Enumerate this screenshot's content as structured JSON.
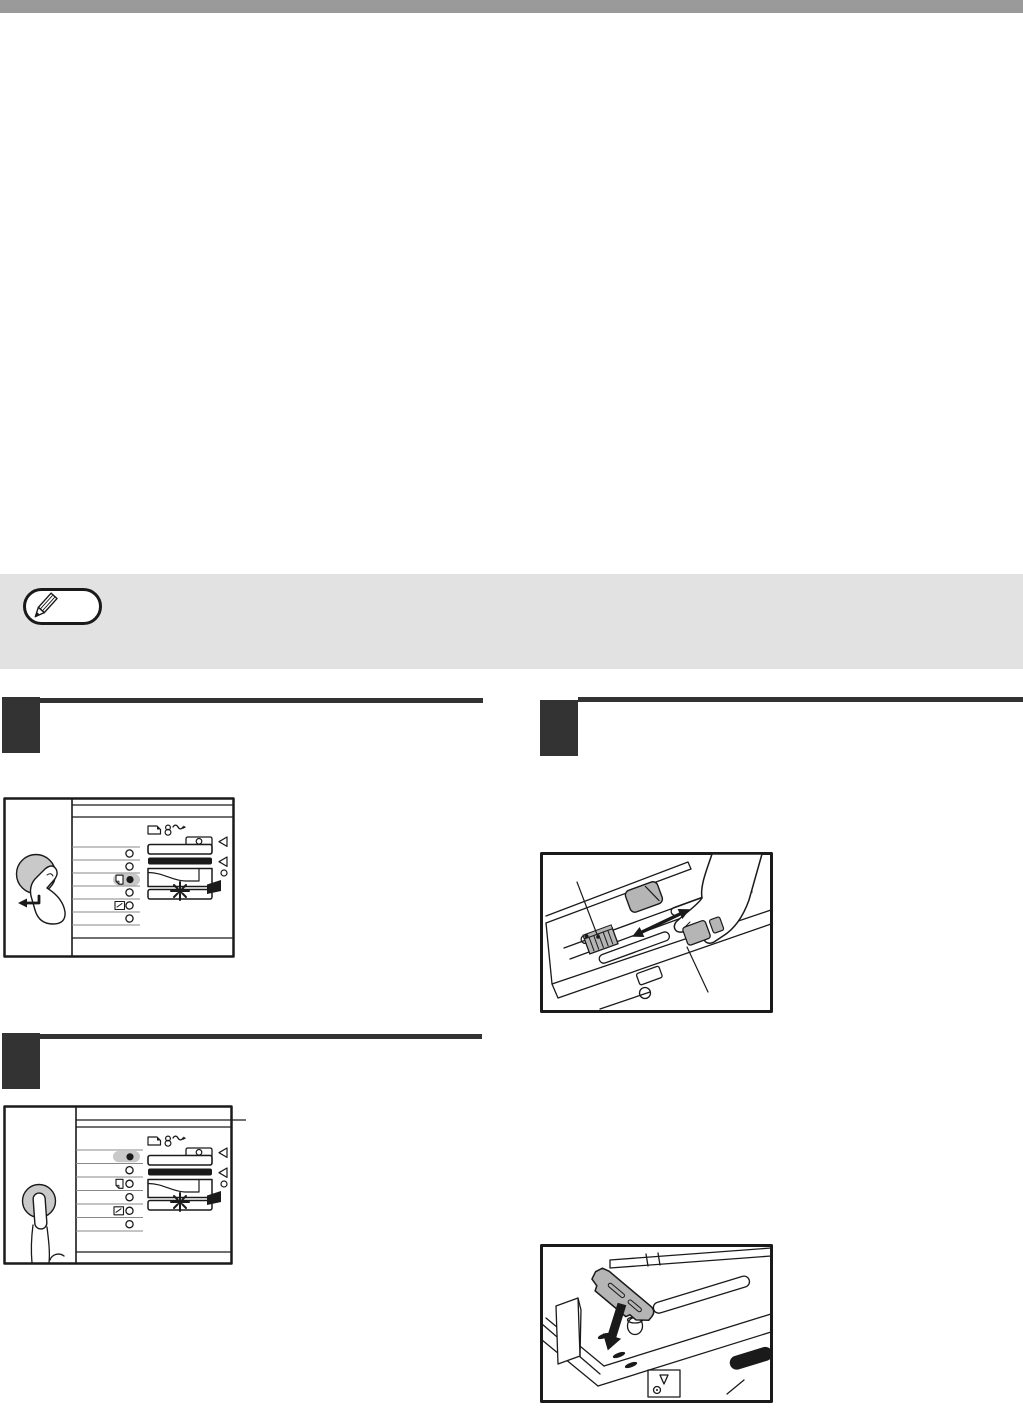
{
  "page": {
    "width": 1023,
    "height": 1412,
    "background": "#ffffff"
  },
  "top_bar": {
    "color": "#9a9a9a",
    "height_px": 13
  },
  "note_box": {
    "background": "#e2e2e2",
    "badge_background": "#ffffff",
    "badge_border": "#1a1a1a",
    "icon": "pencil-icon"
  },
  "colors": {
    "ink": "#1a1a1a",
    "marker": "#333333",
    "row-line": "#8a8a8a",
    "button-gray": "#c9c9c9",
    "guide-gray": "#b5b5b5",
    "note-bg": "#e2e2e2",
    "bar-gray": "#9a9a9a",
    "paper-white": "#ffffff"
  },
  "steps": [
    {
      "id": "step-left-1",
      "column": "left",
      "marker": "filled-square"
    },
    {
      "id": "step-left-2",
      "column": "left",
      "marker": "filled-square"
    },
    {
      "id": "step-right-1",
      "column": "right",
      "marker": "filled-square"
    }
  ],
  "figures": {
    "panel_a": {
      "label": "operation panel: hand pressing round key, enter arrow, third lamp lit, size lamp blinking",
      "icons": [
        "hand-pointing-icon",
        "enter-arrow-icon",
        "paper-feed-location-icon",
        "misfeed-icon",
        "indicator-lamp",
        "selected-indicator-lamp",
        "special-paper-icon",
        "left-triangle-icon",
        "blinking-star-icon"
      ],
      "lamp_rows": 6,
      "lit_row": 3
    },
    "panel_b": {
      "label": "operation panel: hand pressing round key from below, first lamp lit, size lamp blinking",
      "icons": [
        "hand-pointing-icon",
        "paper-feed-location-icon",
        "misfeed-icon",
        "indicator-lamp",
        "selected-indicator-lamp",
        "special-paper-icon",
        "left-triangle-icon",
        "blinking-star-icon"
      ],
      "lamp_rows": 6,
      "lit_row": 1
    },
    "tray_slide": {
      "label": "paper tray: hand squeezing front guide, double arrow showing slide direction, two callout leader lines",
      "icons": [
        "hand-icon",
        "double-arrow-icon",
        "front-guide",
        "serrated-guide",
        "leader-line"
      ]
    },
    "tray_insert": {
      "label": "paper tray corner: gray guide plate inserted downward, thick down arrow, slot holes",
      "icons": [
        "guide-plate",
        "down-arrow-icon",
        "slot-holes",
        "peg",
        "size-plate"
      ]
    }
  }
}
